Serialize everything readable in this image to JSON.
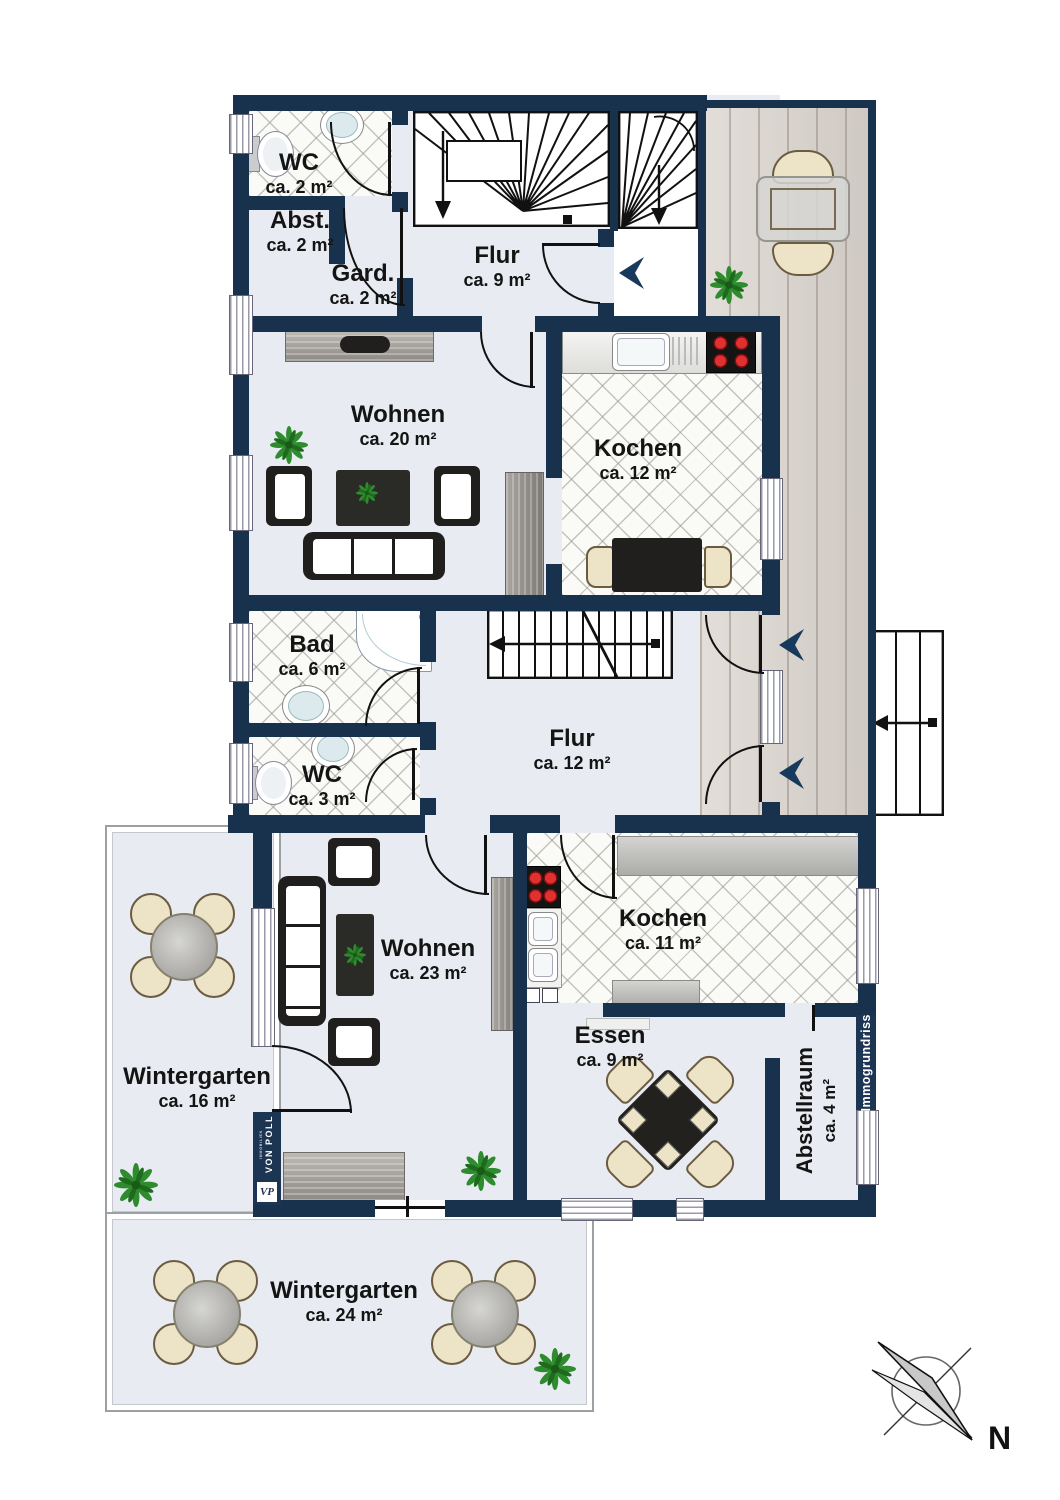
{
  "rooms": [
    {
      "name": "WC",
      "area": "ca. 2 m²"
    },
    {
      "name": "Abst.",
      "area": "ca. 2 m²"
    },
    {
      "name": "Gard.",
      "area": "ca. 2 m²"
    },
    {
      "name": "Flur",
      "area": "ca. 9 m²"
    },
    {
      "name": "Wohnen",
      "area": "ca. 20 m²"
    },
    {
      "name": "Kochen",
      "area": "ca. 12 m²"
    },
    {
      "name": "Bad",
      "area": "ca. 6 m²"
    },
    {
      "name": "WC",
      "area": "ca. 3 m²"
    },
    {
      "name": "Flur",
      "area": "ca. 12 m²"
    },
    {
      "name": "Wintergarten",
      "area": "ca. 16 m²"
    },
    {
      "name": "Wohnen",
      "area": "ca. 23 m²"
    },
    {
      "name": "Kochen",
      "area": "ca. 11 m²"
    },
    {
      "name": "Essen",
      "area": "ca. 9 m²"
    },
    {
      "name": "Abstellraum",
      "area": "ca. 4 m²"
    },
    {
      "name": "Wintergarten",
      "area": "ca. 24 m²"
    }
  ],
  "branding": {
    "logo_line1": "VON POLL",
    "logo_line2": "IMMOBILIEN",
    "logo_monogram": "VP",
    "watermark": "Immogrundriss"
  },
  "compass": {
    "label": "N"
  },
  "colors": {
    "wall": "#18324E",
    "floor": "#E8EBF1",
    "tile": "#FAFAF6",
    "deck": "#D9D3CC",
    "arrow": "#17395C"
  }
}
